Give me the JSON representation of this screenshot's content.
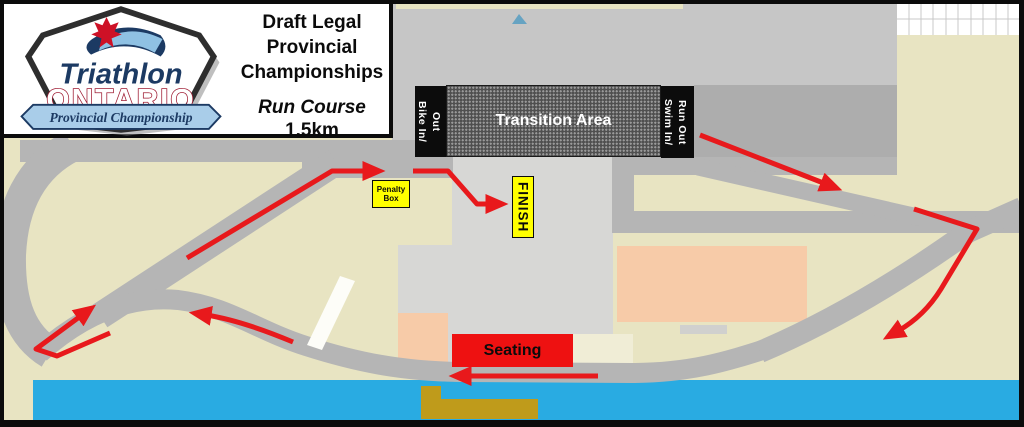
{
  "header": {
    "title_lines": [
      "Draft Legal",
      "Provincial",
      "Championships"
    ],
    "course_label": "Run Course",
    "distance": "1.5km"
  },
  "logo": {
    "brand_top": "Triathlon",
    "brand_main": "ONTARIO",
    "banner": "Provincial Championship"
  },
  "map": {
    "transition_label": "Transition Area",
    "bike_lines": [
      "Bike In/",
      "Out"
    ],
    "swim_lines": [
      "Swim In/",
      "Run Out"
    ],
    "penalty_lines": [
      "Penalty",
      "Box"
    ],
    "finish_label": "FINISH",
    "seating_label": "Seating",
    "colors": {
      "background_land": "#E8E4C2",
      "road": "#B5B5B5",
      "plaza": "#D7D7D5",
      "building_gray": "#ADADAD",
      "top_gray": "#C6C6C6",
      "water": "#29ABE2",
      "course_arrow_red": "#E8191C",
      "seating_red": "#EE1111",
      "marker_yellow": "#FFFF00",
      "dock_olive": "#BF9B1B",
      "building_peach": "#F7CBA8",
      "building_cream": "#F0EDD6"
    }
  }
}
